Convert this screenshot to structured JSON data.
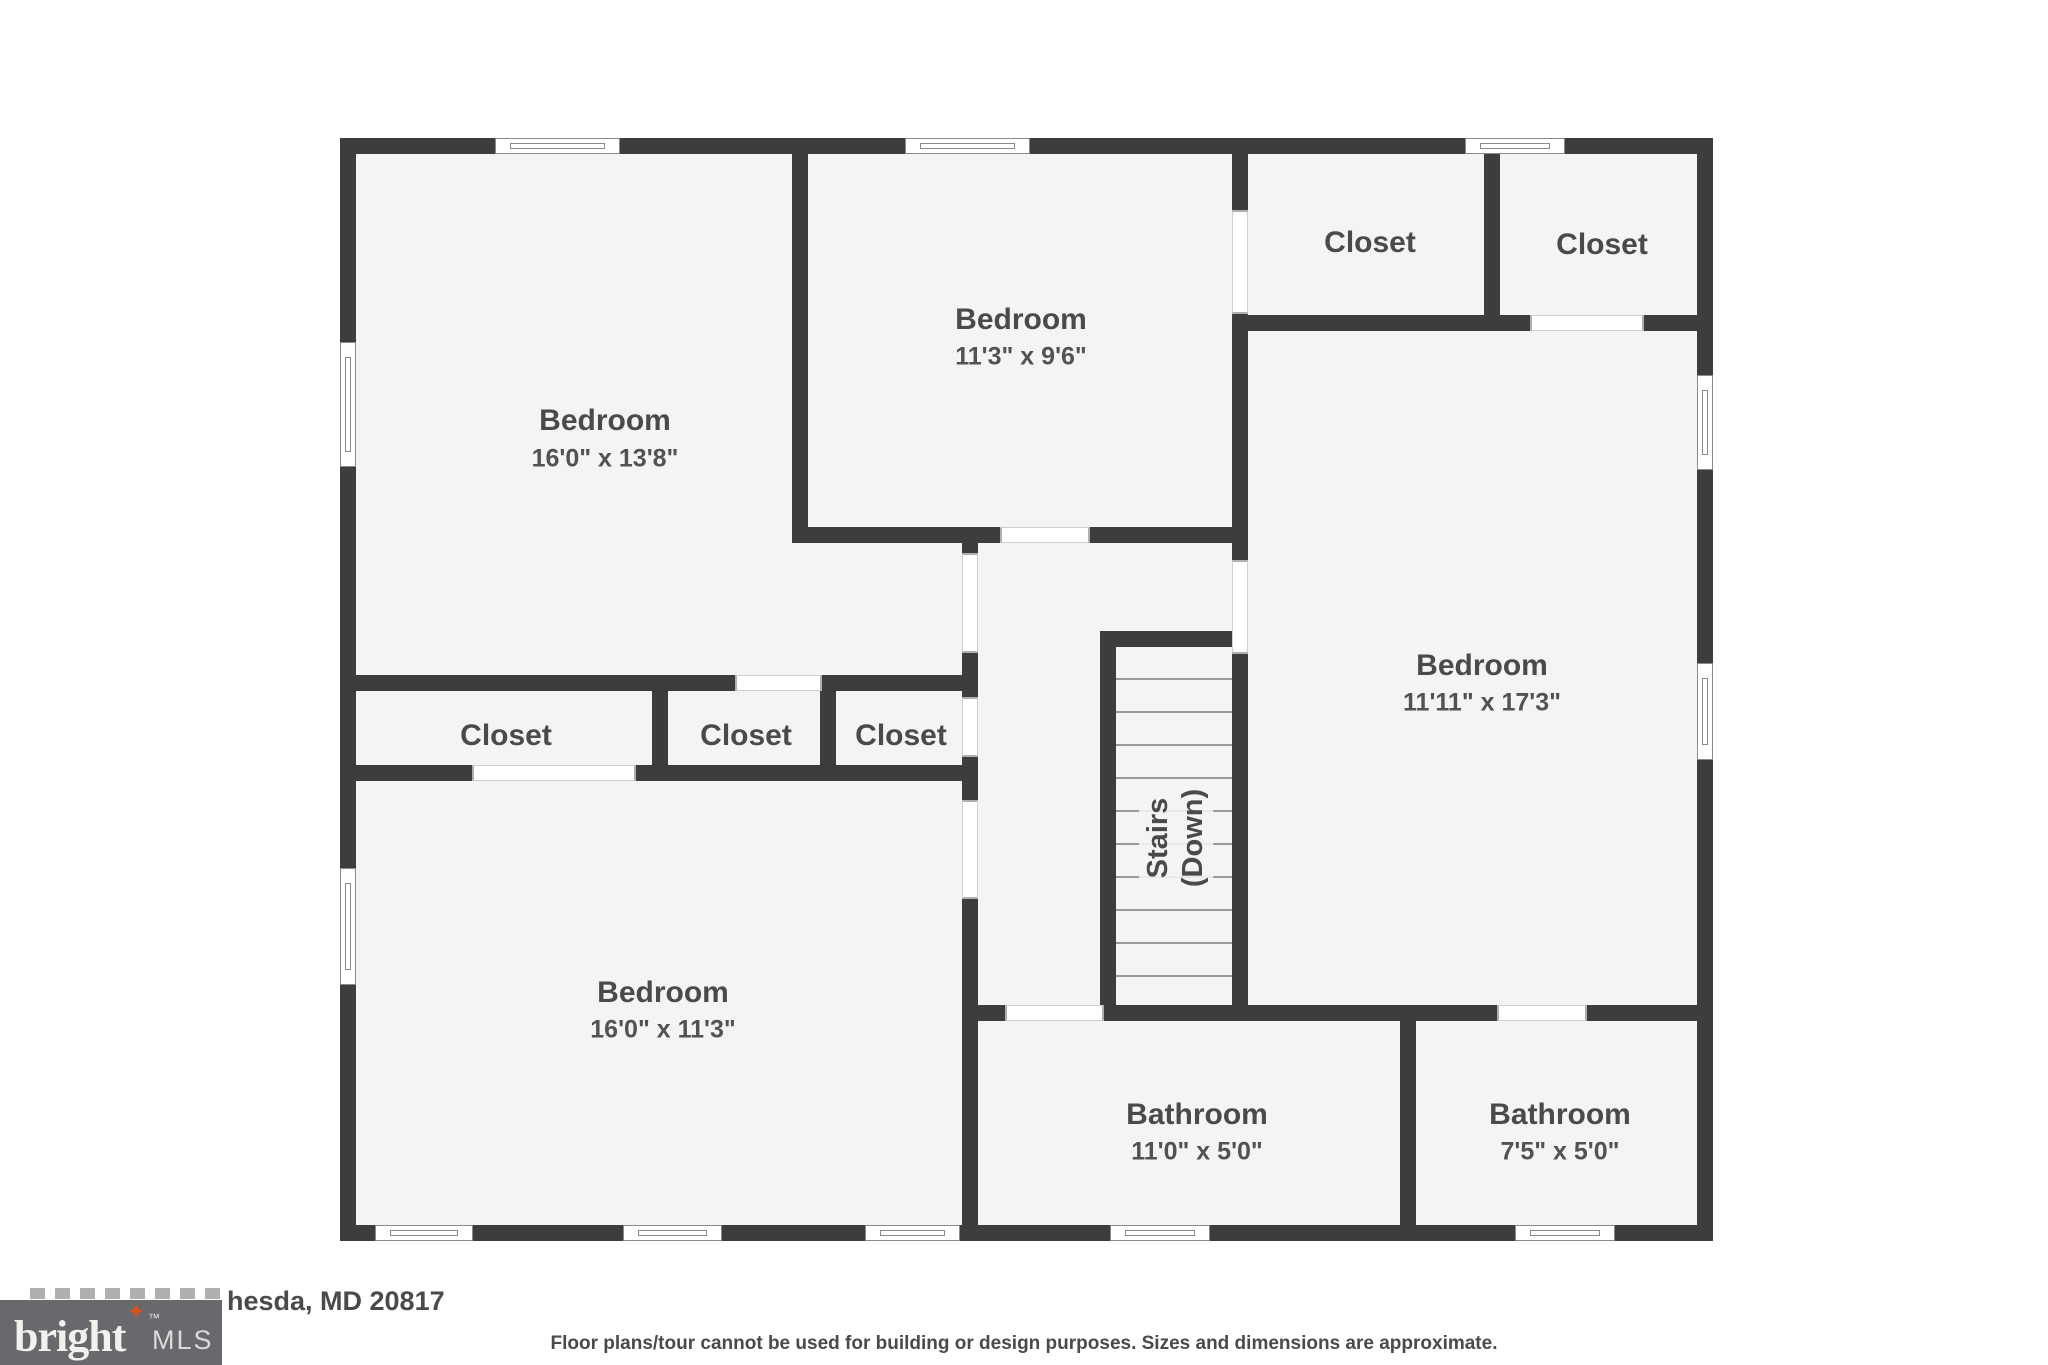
{
  "colors": {
    "wall": "#3d3d3d",
    "floor": "#f4f4f3",
    "label": "#4a4a4a",
    "dims": "#525252",
    "logo_bg": "#69686c",
    "logo_text": "#f3f1ee",
    "logo_star": "#d9531e"
  },
  "plan": {
    "rooms": {
      "bedroom_top_left": {
        "name": "Bedroom",
        "dims": "16'0\" x 13'8\""
      },
      "bedroom_top_middle": {
        "name": "Bedroom",
        "dims": "11'3\" x 9'6\""
      },
      "bedroom_right": {
        "name": "Bedroom",
        "dims": "11'11\" x 17'3\""
      },
      "bedroom_bottom_left": {
        "name": "Bedroom",
        "dims": "16'0\" x 11'3\""
      },
      "bathroom_left": {
        "name": "Bathroom",
        "dims": "11'0\" x 5'0\""
      },
      "bathroom_right": {
        "name": "Bathroom",
        "dims": "7'5\" x 5'0\""
      },
      "closet_top_right_1": {
        "name": "Closet"
      },
      "closet_top_right_2": {
        "name": "Closet"
      },
      "closet_mid_left": {
        "name": "Closet"
      },
      "closet_mid_center": {
        "name": "Closet"
      },
      "closet_mid_right": {
        "name": "Closet"
      },
      "stairs": {
        "line1": "Stairs",
        "line2": "(Down)"
      }
    }
  },
  "footer": {
    "logo": {
      "brand": "bright",
      "trademark": "™",
      "suffix": "MLS",
      "star": "✦"
    },
    "address_visible": "hesda, MD 20817",
    "disclaimer": "Floor plans/tour cannot be used for building or design purposes. Sizes and dimensions are approximate."
  }
}
